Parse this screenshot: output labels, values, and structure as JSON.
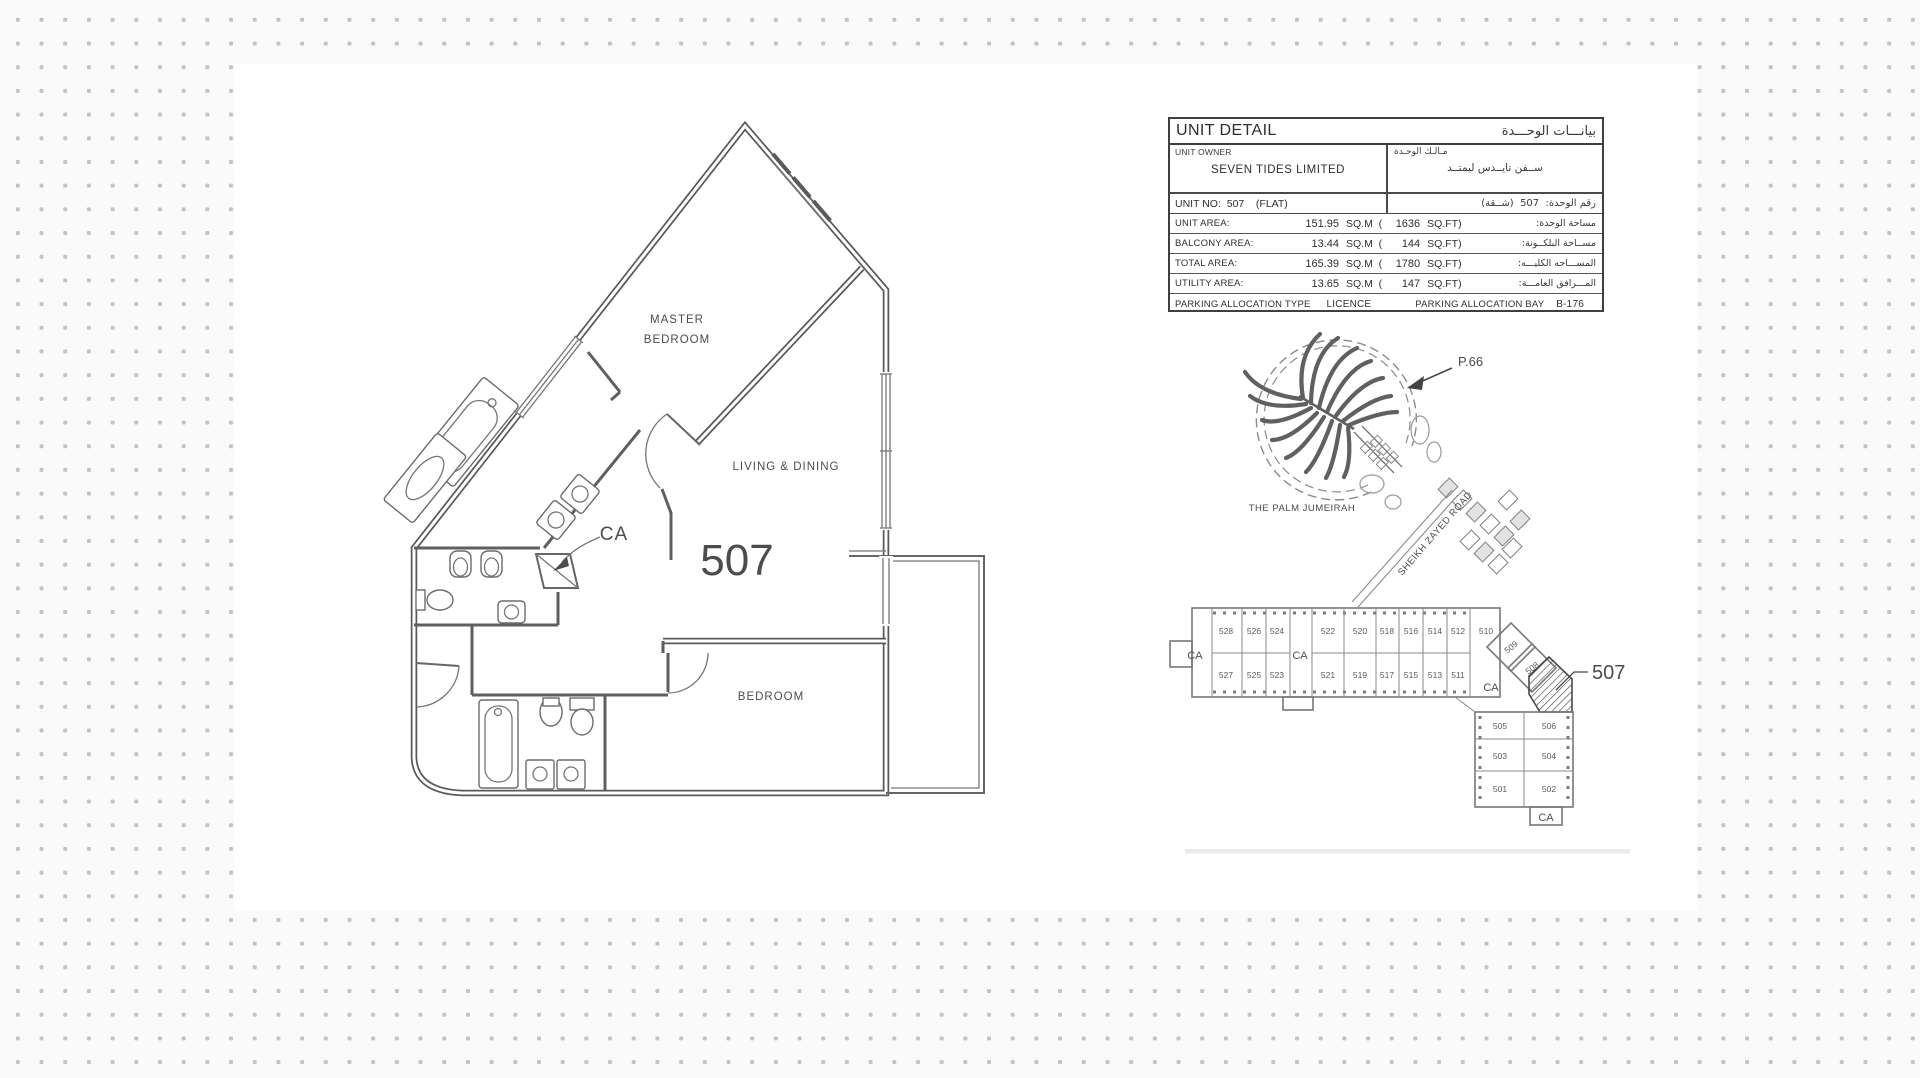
{
  "canvas": {
    "bg": "#fafafa",
    "dot_color": "#c3c3c3",
    "sheet_color": "#ffffff",
    "ink": "#3a3a3a",
    "line": "#5a5a5a"
  },
  "unit_detail": {
    "title_en": "UNIT DETAIL",
    "title_ar": "بيانـــات الوحـــدة",
    "owner_label_en": "UNIT OWNER",
    "owner_label_ar": "مـالـك الوحـدة",
    "owner_value_en": "SEVEN TIDES LIMITED",
    "owner_value_ar": "ســفن تايــدس ليمتــد",
    "unit_no_en": "UNIT NO:  507    (FLAT)",
    "unit_no_ar": "رقم الوحدة:  507  (شــقة)",
    "areas": [
      {
        "label": "UNIT AREA:",
        "sqm": "151.95",
        "sqft": "1636",
        "label_ar": "مساحة الوحدة:"
      },
      {
        "label": "BALCONY AREA:",
        "sqm": "13.44",
        "sqft": "144",
        "label_ar": "مســاحة البلكــونة:"
      },
      {
        "label": "TOTAL AREA:",
        "sqm": "165.39",
        "sqft": "1780",
        "label_ar": "المســـاحه الكليـــه:"
      },
      {
        "label": "UTILITY AREA:",
        "sqm": "13.65",
        "sqft": "147",
        "label_ar": "المـــرافق العامـــة:"
      }
    ],
    "sqm_unit": "SQ.M  (",
    "sqft_unit": "SQ.FT)",
    "parking_type_label": "PARKING ALLOCATION TYPE",
    "parking_type_value": "LICENCE",
    "parking_bay_label": "PARKING ALLOCATION BAY",
    "parking_bay_value": "B-176"
  },
  "floor_plan": {
    "unit_number": "507",
    "master_bedroom_line1": "MASTER",
    "master_bedroom_line2": "BEDROOM",
    "living_dining": "LIVING & DINING",
    "bedroom": "BEDROOM",
    "ca": "CA"
  },
  "location_map": {
    "marker": "P.66",
    "palm_label": "THE PALM JUMEIRAH",
    "road_label": "SHEIKH ZAYED ROAD"
  },
  "key_plan": {
    "top_units": [
      "528",
      "526",
      "524",
      "522",
      "520",
      "518",
      "516",
      "514",
      "512"
    ],
    "corner_unit": "510",
    "bottom_units": [
      "527",
      "525",
      "523",
      "521",
      "519",
      "517",
      "515",
      "513",
      "511"
    ],
    "diagonal_units": [
      "509",
      "508"
    ],
    "block_units": [
      "505",
      "506",
      "503",
      "504",
      "501",
      "502"
    ],
    "highlight_label": "507",
    "ca_left": "CA",
    "ca_mid": "CA",
    "ca_right": "CA",
    "ca_bottom": "CA"
  }
}
